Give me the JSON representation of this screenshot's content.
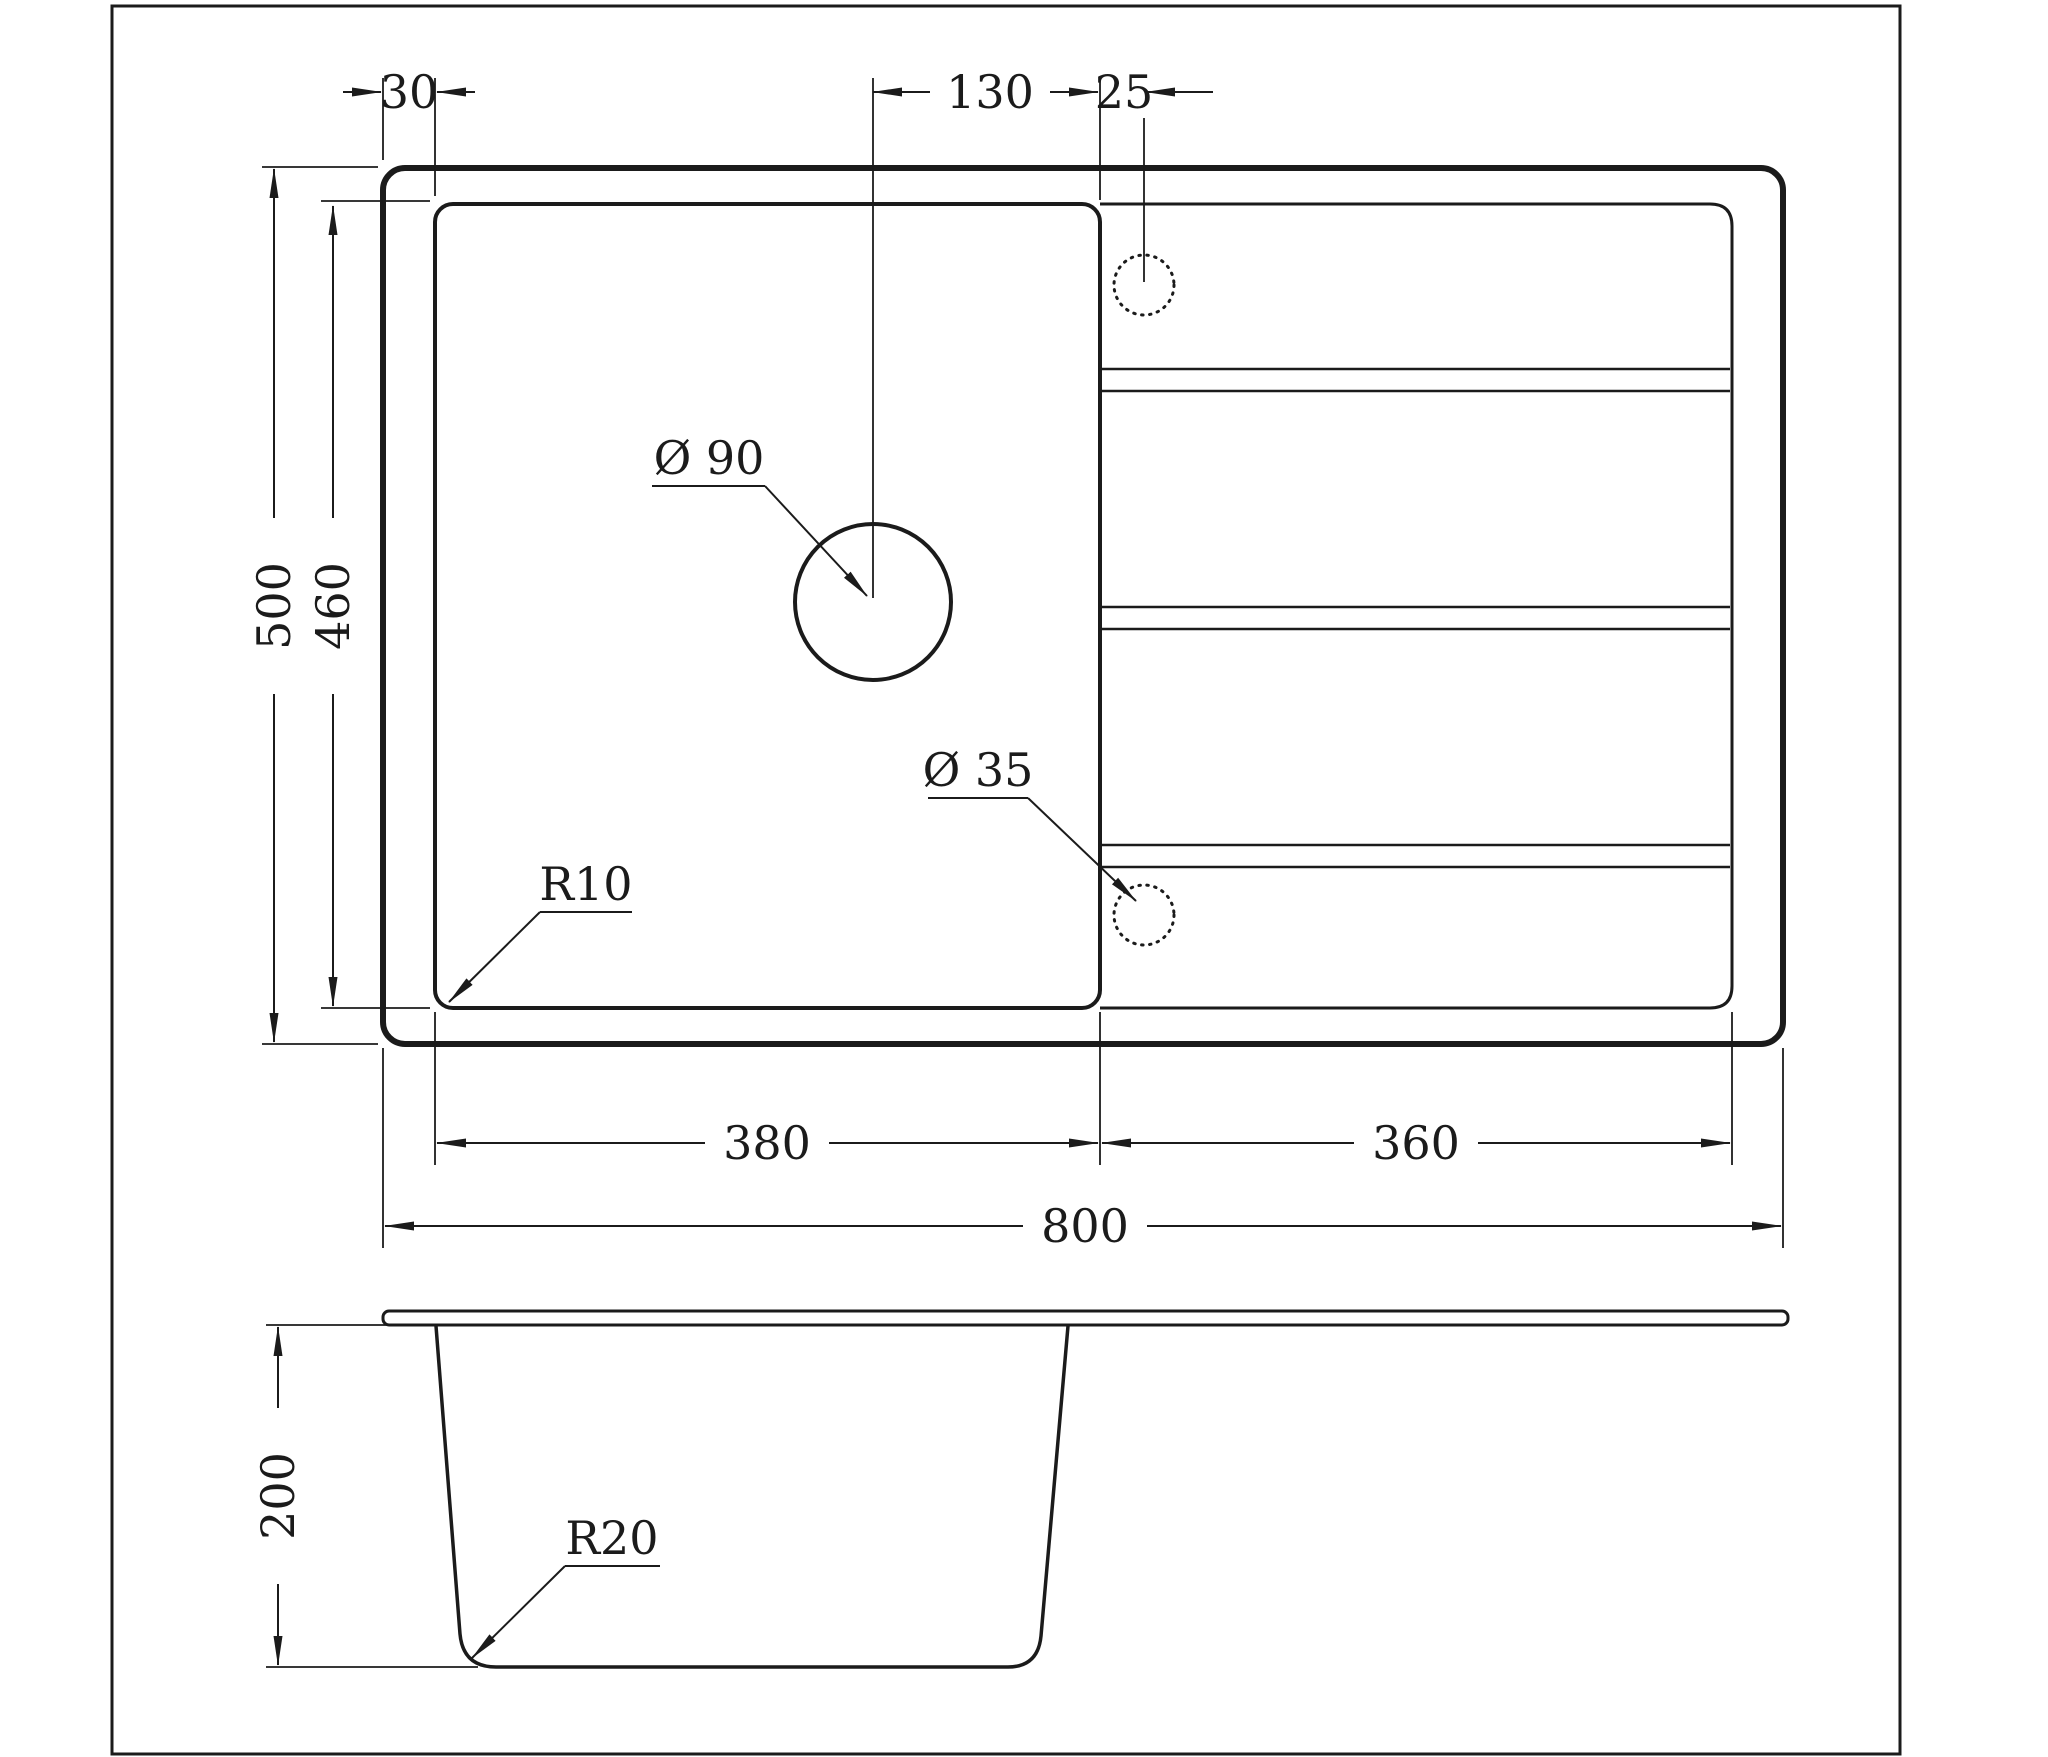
{
  "drawing": {
    "type": "kitchen-sink-technical-drawing",
    "views": {
      "top_view": "top view",
      "side_view": "front section view"
    },
    "dimensions": {
      "bowl_edge_offset": "30",
      "drain_to_divider": "130",
      "tap_hole_offset": "25",
      "overall_depth": "500",
      "bowl_depth": "460",
      "bowl_width": "380",
      "drainboard_width": "360",
      "overall_width": "800",
      "bowl_height": "200"
    },
    "labels": {
      "drain_hole_diameter": "Ø 90",
      "tap_hole_diameter": "Ø 35",
      "bowl_corner_radius": "R10",
      "bottom_corner_radius": "R20"
    },
    "colors": {
      "line": "#1b1b1b",
      "background": "#ffffff"
    }
  }
}
